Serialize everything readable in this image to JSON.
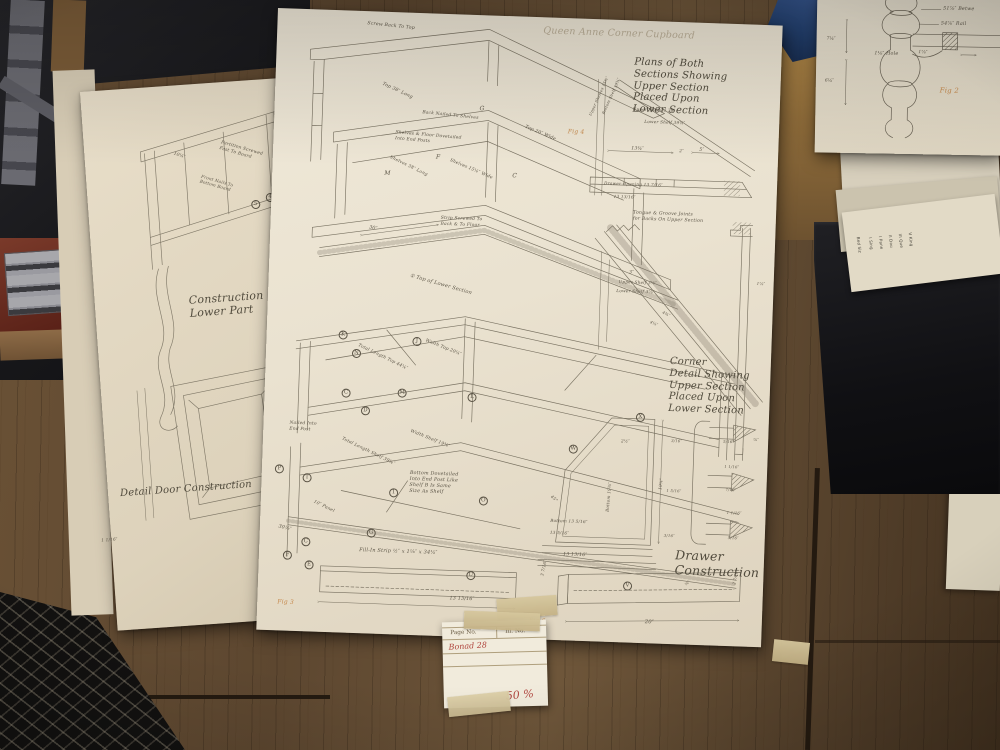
{
  "photo": {
    "main_sheet": {
      "pencil_title": "Queen Anne Corner Cupboard",
      "labels": [
        {
          "t": "Queen Anne Corner Cupboard",
          "x": 266,
          "y": 8,
          "s": 9.5,
          "cls": "pencil"
        },
        {
          "t": "Screw Back To Top",
          "x": 90,
          "y": 10,
          "r": 4,
          "s": 4.6
        },
        {
          "t": "Top 38″ Long",
          "x": 108,
          "y": 70,
          "r": 23,
          "s": 4.6
        },
        {
          "t": "G",
          "x": 205,
          "y": 90,
          "s": 6
        },
        {
          "t": "Top 20″ Wide",
          "x": 252,
          "y": 108,
          "r": 21,
          "s": 4.6
        },
        {
          "t": "Back Nailed To Shelves",
          "x": 148,
          "y": 97,
          "r": 4,
          "s": 4.4
        },
        {
          "t": "M",
          "x": 112,
          "y": 158,
          "s": 6
        },
        {
          "t": "30″",
          "x": 99,
          "y": 214,
          "r": 10,
          "s": 4.8
        },
        {
          "t": "Shelves & Floor Dovetailed\nInto End Posts",
          "x": 122,
          "y": 118,
          "r": 3,
          "s": 4.4
        },
        {
          "t": "Shelves 38″ Long",
          "x": 118,
          "y": 143,
          "r": 24,
          "s": 4.4
        },
        {
          "t": "F",
          "x": 163,
          "y": 140,
          "s": 6
        },
        {
          "t": "Shelves 15¼″ Wide",
          "x": 178,
          "y": 144,
          "r": 21,
          "s": 4.4
        },
        {
          "t": "C",
          "x": 240,
          "y": 156,
          "s": 6
        },
        {
          "t": "Strip Screwed To\nBack & To Floor",
          "x": 170,
          "y": 202,
          "s": 4.4
        },
        {
          "t": "① Top of Lower Section",
          "x": 142,
          "y": 260,
          "r": 14,
          "s": 5
        },
        {
          "t": "Total Length Top 44¼″",
          "x": 93,
          "y": 332,
          "r": 24,
          "s": 4.4
        },
        {
          "t": "Width Top 20¼″",
          "x": 160,
          "y": 325,
          "r": 20,
          "s": 4.4
        },
        {
          "t": "J",
          "x": 146,
          "y": 324,
          "cls": "circ"
        },
        {
          "t": "K",
          "x": 72,
          "y": 320,
          "cls": "circ"
        },
        {
          "t": "N",
          "x": 86,
          "y": 338,
          "cls": "circ"
        },
        {
          "t": "C",
          "x": 77,
          "y": 378,
          "cls": "circ"
        },
        {
          "t": "M",
          "x": 133,
          "y": 376,
          "cls": "circ"
        },
        {
          "t": "L",
          "x": 203,
          "y": 378,
          "cls": "circ"
        },
        {
          "t": "D",
          "x": 97,
          "y": 395,
          "cls": "circ"
        },
        {
          "t": "Nailed Into\nEnd Post",
          "x": 26,
          "y": 412,
          "s": 4.4
        },
        {
          "t": "Total Length Shelf 39¾″",
          "x": 80,
          "y": 426,
          "r": 24,
          "s": 4.4
        },
        {
          "t": "Width Shelf 19⅜″",
          "x": 148,
          "y": 416,
          "r": 20,
          "s": 4.4
        },
        {
          "t": "T",
          "x": 41,
          "y": 464,
          "cls": "circ"
        },
        {
          "t": "P",
          "x": 13,
          "y": 456,
          "cls": "circ"
        },
        {
          "t": "Bottom Dovetailed\nInto End Post Like\nShelf B Is Same\nSize As Shelf",
          "x": 148,
          "y": 458,
          "s": 4.8
        },
        {
          "t": "1",
          "x": 128,
          "y": 476,
          "cls": "circ"
        },
        {
          "t": "O",
          "x": 218,
          "y": 481,
          "cls": "circ"
        },
        {
          "t": "10″ Panel",
          "x": 54,
          "y": 490,
          "r": 24,
          "s": 4.4
        },
        {
          "t": "30⅛″",
          "x": 19,
          "y": 516,
          "r": 12,
          "s": 4.8
        },
        {
          "t": "C",
          "x": 42,
          "y": 528,
          "cls": "circ"
        },
        {
          "t": "G",
          "x": 107,
          "y": 517,
          "cls": "circ"
        },
        {
          "t": "F",
          "x": 24,
          "y": 542,
          "cls": "circ"
        },
        {
          "t": "E",
          "x": 46,
          "y": 551,
          "cls": "circ"
        },
        {
          "t": "Fill-In Strip  ½″ x 1⅛″ x 34¼″",
          "x": 100,
          "y": 536,
          "s": 5
        },
        {
          "t": "Plans of Both\nSections Showing\nUpper Section\nPlaced Upon\nLower Section",
          "x": 358,
          "y": 36,
          "s": 10,
          "cls": "cur"
        },
        {
          "t": "Fig 4",
          "x": 294,
          "y": 110,
          "cls": "fig"
        },
        {
          "t": "Upper Shelves 38″",
          "x": 358,
          "y": 86,
          "s": 4.2
        },
        {
          "t": "Lower Shelf 39¼″",
          "x": 370,
          "y": 98,
          "s": 4.2
        },
        {
          "t": "Upper Shelves 15¾″",
          "x": 314,
          "y": 96,
          "r": -68,
          "s": 3.8
        },
        {
          "t": "Bottom Shelf 19¾″",
          "x": 327,
          "y": 94,
          "r": -68,
          "s": 3.8
        },
        {
          "t": "13¾″",
          "x": 358,
          "y": 126,
          "s": 4.6
        },
        {
          "t": "2″",
          "x": 406,
          "y": 126,
          "s": 4.2
        },
        {
          "t": "5″",
          "x": 426,
          "y": 125,
          "s": 4.6
        },
        {
          "t": "Drawer Opening 13 7/16″",
          "x": 332,
          "y": 161,
          "s": 4.2
        },
        {
          "t": "13 13/16″",
          "x": 342,
          "y": 174,
          "s": 4.2
        },
        {
          "t": "Tongue & Groove Joints\nfor Backs On Upper Section",
          "x": 362,
          "y": 190,
          "s": 4.6
        },
        {
          "t": "3″",
          "x": 360,
          "y": 250,
          "s": 4.6
        },
        {
          "t": "Upper Shelf 3¼″",
          "x": 350,
          "y": 259,
          "s": 4.2
        },
        {
          "t": "Lower Shelf 3⅞″",
          "x": 348,
          "y": 268,
          "s": 4.2
        },
        {
          "t": "4¾″",
          "x": 396,
          "y": 288,
          "r": 24,
          "s": 4
        },
        {
          "t": "4⅛″",
          "x": 384,
          "y": 298,
          "r": 24,
          "s": 4
        },
        {
          "t": "1⅞″",
          "x": 488,
          "y": 256,
          "s": 4
        },
        {
          "t": "⅞″",
          "x": 490,
          "y": 412,
          "s": 4
        },
        {
          "t": "Corner\nDetail Showing\nUpper Section\nPlaced Upon\nLower Section",
          "x": 404,
          "y": 334,
          "s": 10,
          "cls": "cur"
        },
        {
          "t": "W",
          "x": 306,
          "y": 426,
          "cls": "circ"
        },
        {
          "t": "X",
          "x": 372,
          "y": 392,
          "cls": "circ"
        },
        {
          "t": "2½″",
          "x": 358,
          "y": 418,
          "s": 4.2
        },
        {
          "t": "Bottom 19⅜″",
          "x": 344,
          "y": 492,
          "r": -87,
          "s": 4.2
        },
        {
          "t": "19¾″",
          "x": 396,
          "y": 468,
          "r": -85,
          "s": 4.2
        },
        {
          "t": "45°",
          "x": 292,
          "y": 476,
          "r": 40,
          "s": 4.2
        },
        {
          "t": "Bottom 13 5/16″",
          "x": 290,
          "y": 500,
          "s": 4.2
        },
        {
          "t": "13 5/16″",
          "x": 290,
          "y": 512,
          "s": 4.2
        },
        {
          "t": "13 13/16″",
          "x": 304,
          "y": 534,
          "s": 4.6
        },
        {
          "t": "5/16″",
          "x": 460,
          "y": 416,
          "s": 3.8
        },
        {
          "t": "1 1/16″",
          "x": 462,
          "y": 441,
          "s": 3.8
        },
        {
          "t": "7/16″",
          "x": 464,
          "y": 464,
          "s": 3.8
        },
        {
          "t": "1 1/16″",
          "x": 466,
          "y": 487,
          "s": 3.8
        },
        {
          "t": "5/16″",
          "x": 468,
          "y": 512,
          "s": 3.8
        },
        {
          "t": "3/16″",
          "x": 408,
          "y": 417,
          "s": 3.8
        },
        {
          "t": "1 5/16″",
          "x": 405,
          "y": 467,
          "s": 3.8
        },
        {
          "t": "3/16″",
          "x": 404,
          "y": 512,
          "s": 3.8
        },
        {
          "t": "Drawer\nConstruction",
          "x": 416,
          "y": 526,
          "s": 12.5,
          "cls": "cur"
        },
        {
          "t": "U",
          "x": 208,
          "y": 556,
          "cls": "circ"
        },
        {
          "t": "13 13/16″",
          "x": 192,
          "y": 582,
          "s": 4.8
        },
        {
          "t": "3 7/16″",
          "x": 281,
          "y": 558,
          "r": -80,
          "s": 4.2
        },
        {
          "t": "Fig 6",
          "x": 272,
          "y": 600,
          "cls": "fig"
        },
        {
          "t": "V",
          "x": 365,
          "y": 561,
          "cls": "circ"
        },
        {
          "t": "20″",
          "x": 388,
          "y": 598,
          "s": 5.2
        },
        {
          "t": "⅝″",
          "x": 426,
          "y": 561,
          "r": -45,
          "s": 3.8
        },
        {
          "t": "2 7/16″",
          "x": 474,
          "y": 560,
          "r": -80,
          "s": 3.8
        },
        {
          "t": "Fig 3",
          "x": 20,
          "y": 590,
          "cls": "fig"
        }
      ]
    },
    "left_sheet": {
      "labels": [
        {
          "t": "Partition Screwed\nFast To Board",
          "x": 138,
          "y": 58,
          "r": 20,
          "s": 4.4
        },
        {
          "t": "10¼″",
          "x": 90,
          "y": 66,
          "r": 22,
          "s": 4.4
        },
        {
          "t": "Front Nails To\nBottom Board",
          "x": 116,
          "y": 90,
          "r": 20,
          "s": 4.2
        },
        {
          "t": "5",
          "x": 163,
          "y": 120,
          "cls": "circ"
        },
        {
          "t": "4",
          "x": 178,
          "y": 114,
          "cls": "circ"
        },
        {
          "t": "Construction\nLower Part",
          "x": 94,
          "y": 210,
          "s": 11,
          "cls": "cur"
        },
        {
          "t": "Detail Door Construction",
          "x": 12,
          "y": 398,
          "s": 10,
          "cls": "cur"
        },
        {
          "t": "1 1/16″",
          "x": -10,
          "y": 446,
          "s": 4.2
        }
      ]
    },
    "top_right_sheet": {
      "labels": [
        {
          "t": "51⅞″ Betwe",
          "x": 126,
          "y": 12,
          "s": 4.8
        },
        {
          "t": "54⅞″ Rail",
          "x": 124,
          "y": 27,
          "s": 4.8
        },
        {
          "t": "1⅛″ Hole",
          "x": 58,
          "y": 58,
          "s": 4.8
        },
        {
          "t": "1⅞″",
          "x": 102,
          "y": 56,
          "s": 4.4
        },
        {
          "t": "7¼″",
          "x": 10,
          "y": 44,
          "s": 4.4
        },
        {
          "t": "6¼″",
          "x": 9,
          "y": 86,
          "s": 4.4
        },
        {
          "t": "Fig 2",
          "x": 124,
          "y": 92,
          "s": 7,
          "cls": "fig"
        }
      ]
    },
    "side_stack": {
      "labels": [
        {
          "t": "Bed Siz",
          "x": 16,
          "y": 26,
          "r": 90,
          "s": 4,
          "cls": "side"
        },
        {
          "t": "I Sing",
          "x": 28,
          "y": 28,
          "r": 90,
          "s": 4,
          "cls": "side"
        },
        {
          "t": "I Pane",
          "x": 38,
          "y": 28,
          "r": 90,
          "s": 4,
          "cls": "side"
        },
        {
          "t": "II Dou",
          "x": 48,
          "y": 28,
          "r": 90,
          "s": 4,
          "cls": "side"
        },
        {
          "t": "III Que",
          "x": 58,
          "y": 28,
          "r": 90,
          "s": 4,
          "cls": "side"
        },
        {
          "t": "V King",
          "x": 68,
          "y": 28,
          "r": 90,
          "s": 4,
          "cls": "side"
        }
      ]
    },
    "tag_card": {
      "page_no_label": "Page No.",
      "ill_no_label": "Ill. No.",
      "page_no_value": "Bonad 28",
      "scale_note": "50 %"
    },
    "colors": {
      "red_ink": "#b0453e",
      "orange_pencil": "#c07a35",
      "ink": "#5a5345",
      "paper": "#ece4d2"
    }
  }
}
